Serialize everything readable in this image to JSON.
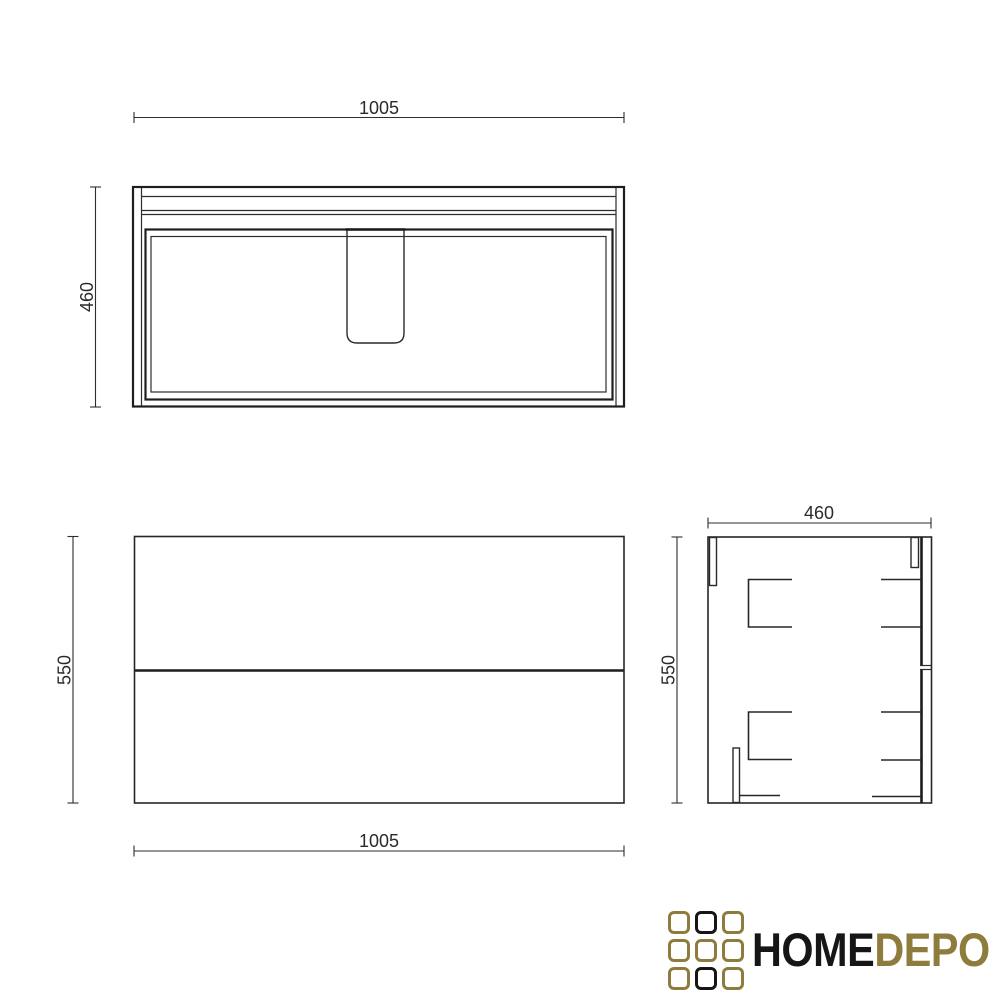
{
  "drawing": {
    "top_view": {
      "width_label": "1005",
      "depth_label": "460"
    },
    "front_view": {
      "width_label": "1005",
      "height_label": "550"
    },
    "side_view": {
      "depth_label": "460",
      "height_label": "550"
    }
  },
  "logo": {
    "text_primary": "HOME",
    "text_secondary": "DEPO",
    "gold_color": "#8e7c3c",
    "dark_color": "#161616",
    "grid": [
      "gold",
      "black",
      "gold",
      "gold",
      "gold",
      "gold",
      "gold",
      "black",
      "gold"
    ]
  },
  "colors": {
    "background": "#ffffff",
    "line": "#2a2a2a"
  }
}
